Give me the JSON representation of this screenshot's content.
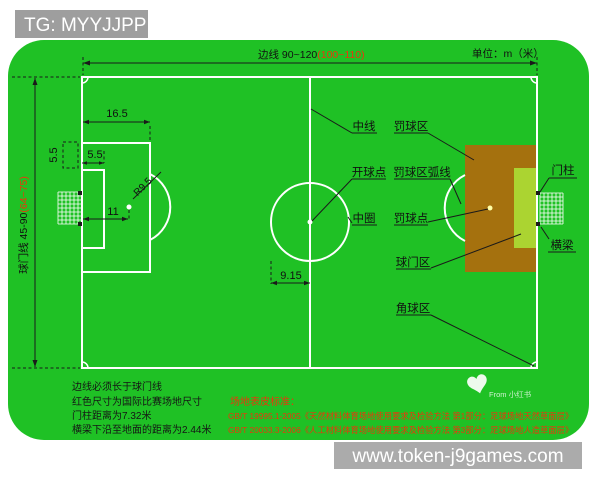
{
  "watermarks": {
    "top_left": "TG: MYYJJPP",
    "bottom_right": "www.token-j9games.com",
    "source": "From 小红书"
  },
  "header": {
    "touchline_black": "边线 90~120",
    "touchline_red": "(100~110)",
    "unit": "单位：m（米）"
  },
  "goal_line_axis": {
    "black": "球门线 45-90",
    "red": "(64~75)"
  },
  "dims": {
    "penalty_depth": "16.5",
    "goal_depth": "5.5",
    "goal_side": "5.5",
    "penalty_spot": "11",
    "arc_radius": "R9.5",
    "circle_radius": "9.15"
  },
  "labels": {
    "center_line": "中线",
    "penalty_area": "罚球区",
    "kickoff_point": "开球点",
    "penalty_arc": "罚球区弧线",
    "center_circle": "中圈",
    "penalty_spot": "罚球点",
    "goal_area": "球门区",
    "corner_area": "角球区",
    "goal_post": "门柱",
    "crossbar": "横梁"
  },
  "notes_left": [
    "边线必须长于球门线",
    "红色尺寸为国际比赛场地尺寸",
    "门柱距离为7.32米",
    "横梁下沿至地面的距离为2.44米"
  ],
  "surface_standards": {
    "title": "场地表皮标准：",
    "items": [
      "GB/T 19995.1-2005《天然材料体育场地使用要求及检验方法 第1部分：足球场地天然草面层》",
      "GB/T 20033.3-2006《人工材料体育场地使用要求及检验方法 第3部分：足球场地人造草面层》"
    ]
  },
  "colors": {
    "field_green": "#1fc125",
    "penalty_brown": "#a5710e",
    "goal_area_green": "#abd431",
    "red_text": "#e8380d",
    "watermark_gray": "#9e9e9e",
    "bottom_bar_gray": "#ababab"
  }
}
